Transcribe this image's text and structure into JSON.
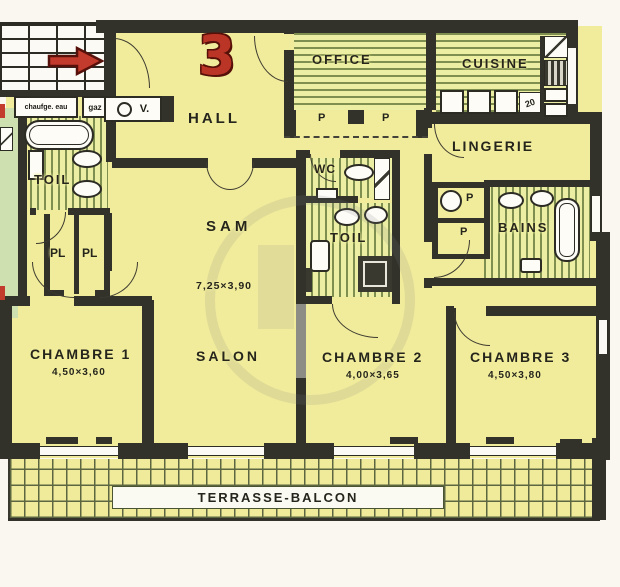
{
  "apartment": {
    "number": "3"
  },
  "rooms": {
    "hall": "HALL",
    "office": "OFFICE",
    "cuisine": "CUISINE",
    "lingerie": "LINGERIE",
    "toilette_gauche": "TOIL",
    "wc": "WC",
    "toilette_centrale": "TOIL",
    "bains": "BAINS",
    "sam": "SAM",
    "salon": "SALON",
    "chambre1": "CHAMBRE 1",
    "chambre2": "CHAMBRE 2",
    "chambre3": "CHAMBRE 3",
    "terrasse": "TERRASSE-BALCON"
  },
  "dimensions": {
    "sam": "7,25×3,90",
    "chambre1": "4,50×3,60",
    "chambre2": "4,00×3,65",
    "chambre3": "4,50×3,80"
  },
  "annotations": {
    "chauffe_eau": "chaufge. eau",
    "gaz": "gaz",
    "vestiaire": "V.",
    "placard_left_1": "PL",
    "placard_left_2": "PL",
    "placard_office_1": "P",
    "placard_office_2": "P",
    "placard_bains_1": "P",
    "placard_bains_2": "P",
    "kitchen_badge": "20"
  },
  "colors": {
    "room_fill": "#f1ec9b",
    "hatch_line": "#7f8f50",
    "wall": "#32312a",
    "accent_red": "#c23b2c",
    "outside_green": "#cfe0b0",
    "terrace_grid": "#5c6741"
  }
}
